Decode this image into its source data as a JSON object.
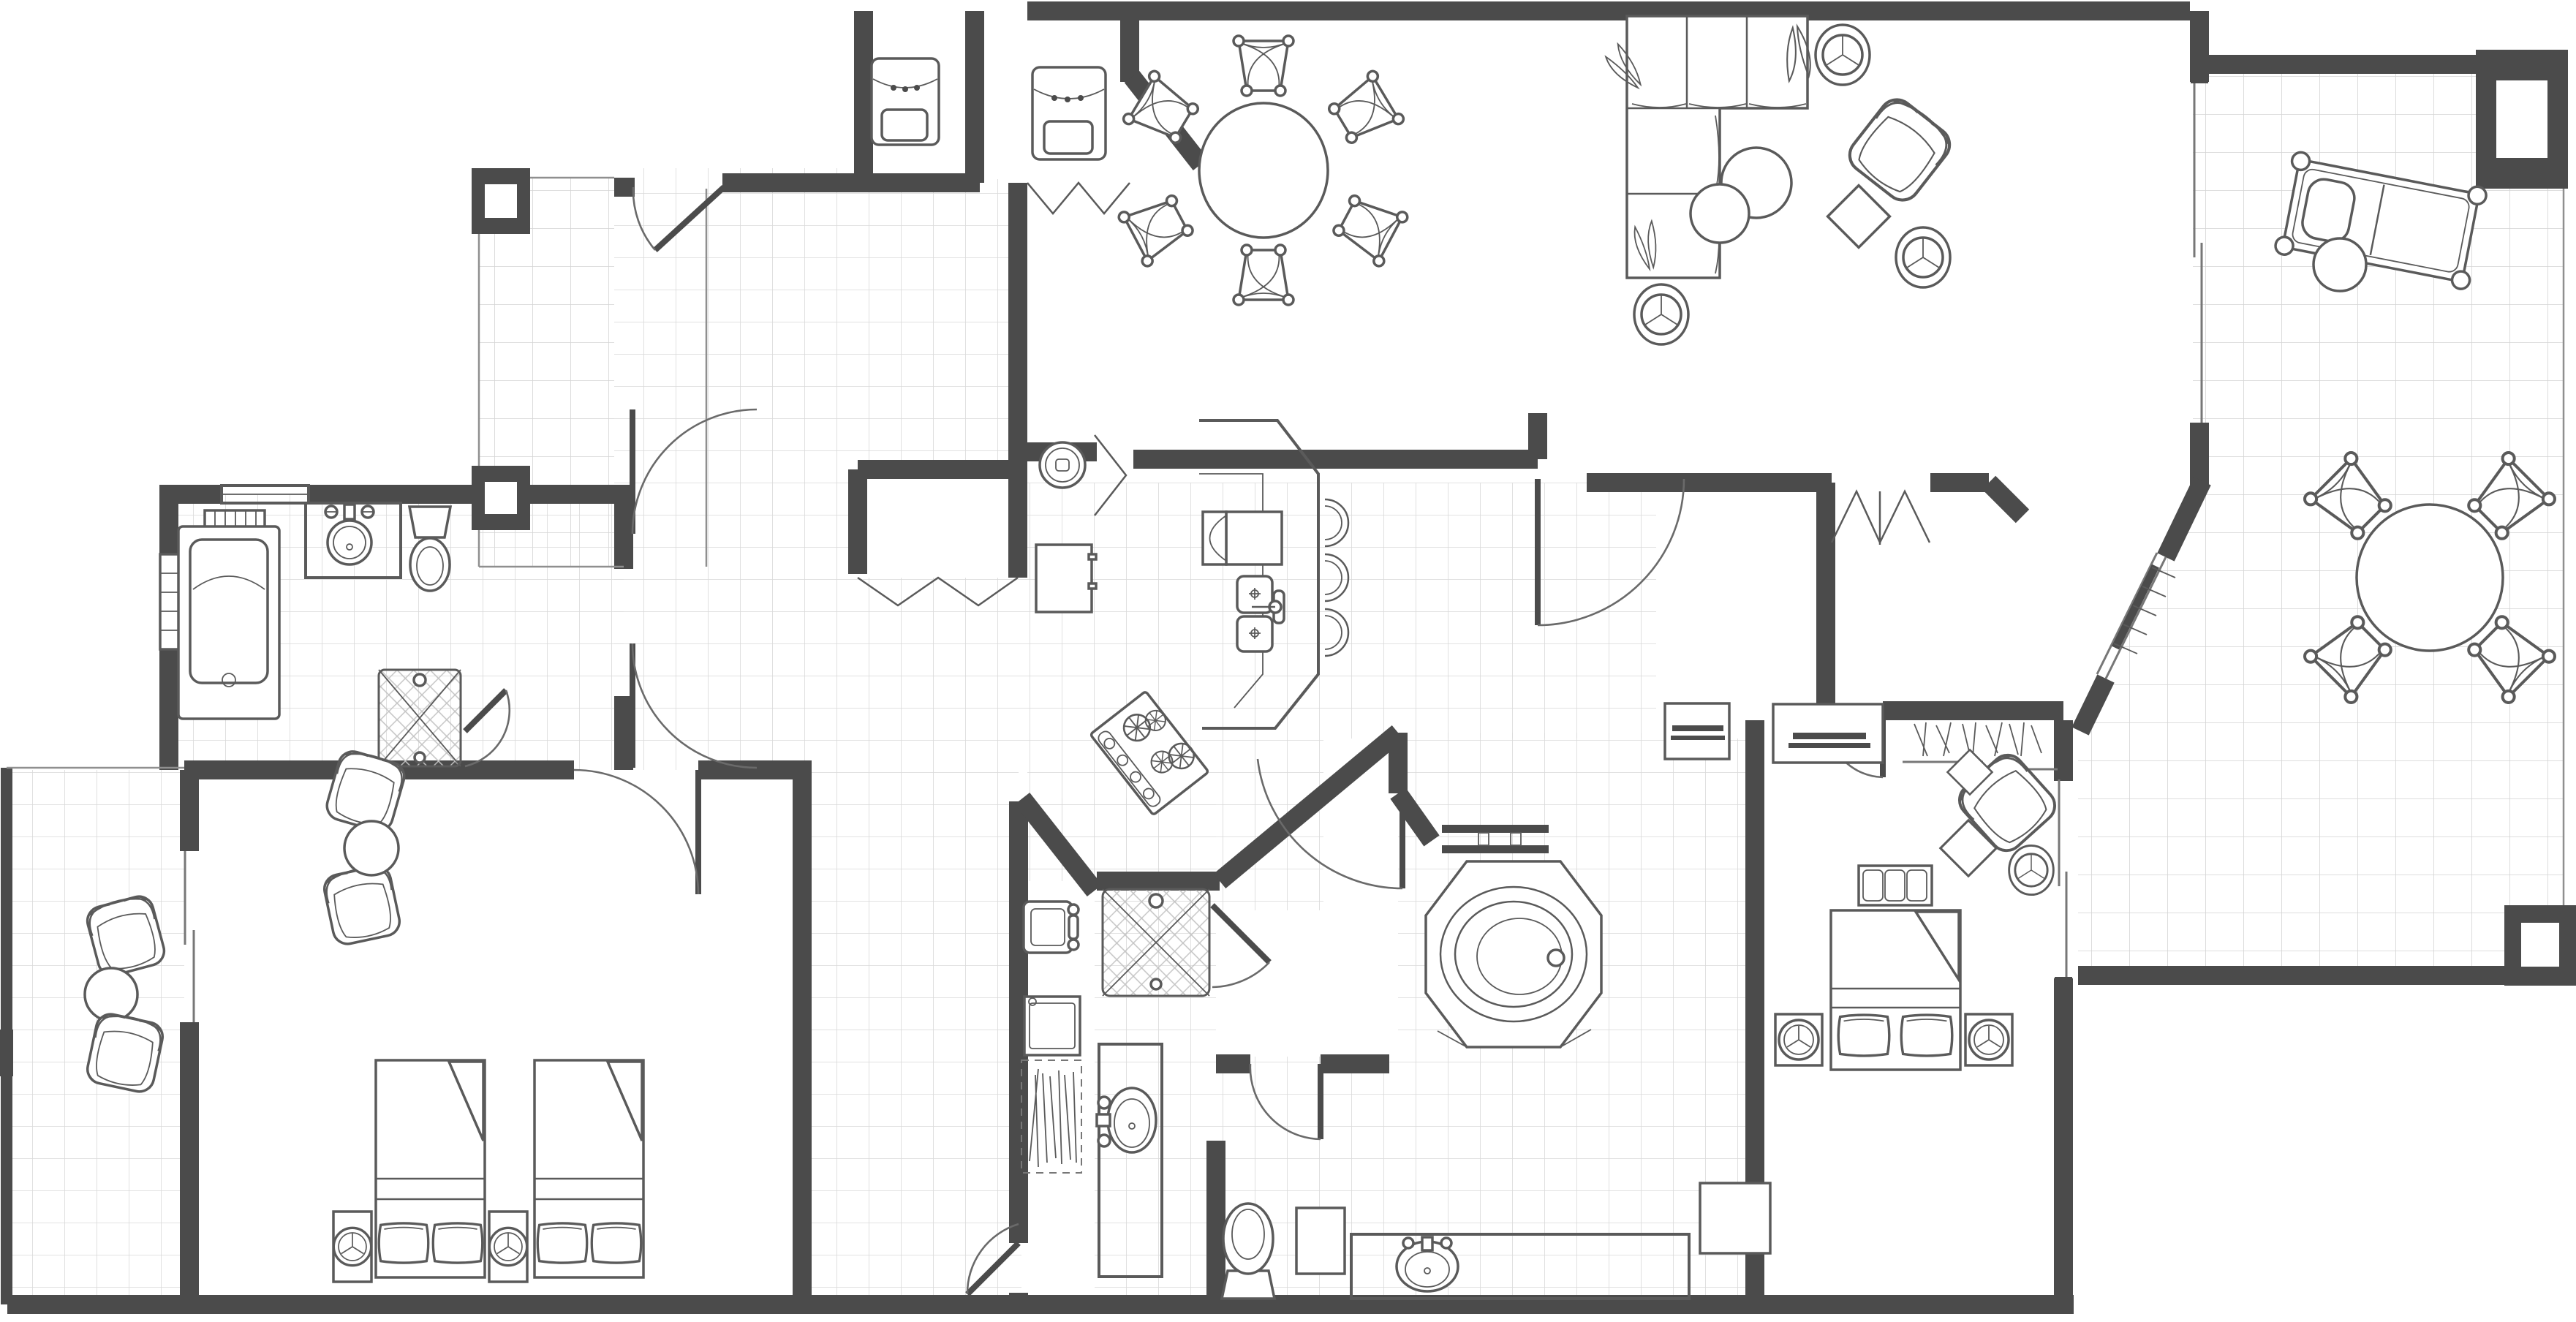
{
  "page": {
    "title": "Two-Bedroom Suite Floor Plan",
    "document_type": "architectural floor plan, top view line drawing",
    "orientation": "landscape"
  },
  "colors": {
    "wall": "#4b4b4b",
    "furniture_line": "#5a5a5a",
    "tile_line": "#d9d9d9",
    "background": "#ffffff",
    "hatch": "#c3c3c3"
  },
  "rooms": [
    {
      "id": "entry-porch",
      "name": "Entry porch",
      "features": [
        "tiled walkway",
        "two square columns"
      ]
    },
    {
      "id": "foyer",
      "name": "Foyer",
      "features": [
        "tiled floor",
        "entry door",
        "double interior door swings"
      ]
    },
    {
      "id": "utility-closets",
      "name": "Utility closets",
      "features": [
        "air handler cabinet",
        "water heater cabinet",
        "bifold doors",
        "canted corner wall"
      ]
    },
    {
      "id": "coat-closet",
      "name": "Foyer closet",
      "features": [
        "double bifold doors"
      ]
    },
    {
      "id": "bathroom-1",
      "name": "Bathroom 1",
      "features": [
        "jetted tub with window blinds",
        "round vanity sink",
        "toilet",
        "corner shower with tile hatch"
      ]
    },
    {
      "id": "bedroom-1",
      "name": "Bedroom 1",
      "features": [
        "two double beds with pillows and folded spreads",
        "two nightstands with lamps",
        "two armchairs",
        "round side table"
      ]
    },
    {
      "id": "patio",
      "name": "Patio",
      "features": [
        "tiled floor",
        "two lounge chairs",
        "round side table",
        "sliding glass door"
      ]
    },
    {
      "id": "hallway",
      "name": "Hallway / corridor",
      "features": [
        "tiled floor",
        "doors to bedroom 1 and bathroom 2"
      ]
    },
    {
      "id": "kitchen",
      "name": "Kitchen",
      "features": [
        "G-shaped counter with breakfast bar",
        "double sink",
        "dishwasher",
        "refrigerator",
        "four-burner cooktop",
        "washer closet with bifold door"
      ]
    },
    {
      "id": "dining-area",
      "name": "Dining area",
      "features": [
        "round dining table",
        "six fan-back chairs"
      ]
    },
    {
      "id": "living-room",
      "name": "Living room",
      "features": [
        "L-shaped sectional sofa with leaf pillows",
        "two nesting round coffee tables",
        "accent armchair",
        "diamond ottoman",
        "three round lamp tables",
        "sliding glass door to balcony"
      ]
    },
    {
      "id": "laundry-closet",
      "name": "Laundry closet",
      "features": [
        "utility sink",
        "washer-dryer",
        "linen shelves with hatch marks"
      ]
    },
    {
      "id": "bathroom-2",
      "name": "Bathroom 2",
      "features": [
        "square shower with tile hatch",
        "oval vanity sink",
        "toilet"
      ]
    },
    {
      "id": "master-bathroom",
      "name": "Master bathroom",
      "features": [
        "octagonal garden tub platform",
        "oval soaking tub",
        "vanity with oval sink",
        "hamper",
        "accent table",
        "towel bars"
      ]
    },
    {
      "id": "master-bedroom",
      "name": "Master bedroom",
      "features": [
        "king bed with pillows and folded spread",
        "two nightstands with lamps",
        "foot bench",
        "dresser with television",
        "accent armchair",
        "two diamond side tables",
        "closet with hanging rod and sliding doors",
        "double peaked entry doors",
        "angled window wall",
        "sliding glass door to balcony"
      ]
    },
    {
      "id": "balcony",
      "name": "Wraparound balcony",
      "features": [
        "tiled floor",
        "round table with four chairs",
        "chaise lounge",
        "round side table",
        "two square columns"
      ]
    }
  ],
  "furniture_counts": {
    "dining_chairs": 6,
    "balcony_chairs": 4,
    "bar_stools": 3,
    "bedroom1_beds": 2,
    "lounge_chairs_patio": 2,
    "columns": 4,
    "showers": 2,
    "tubs": 2,
    "toilets": 3,
    "sinks": 6
  },
  "icons": {
    "lamp_table": "three-spoke round lamp symbol",
    "shower": "crosshatched square with X diagonals",
    "closet_rod": "slash hatch cluster",
    "window": "double thin parallel lines",
    "sliding_door": "offset overlapping thin lines",
    "door": "quarter-circle swing arc with panel"
  }
}
